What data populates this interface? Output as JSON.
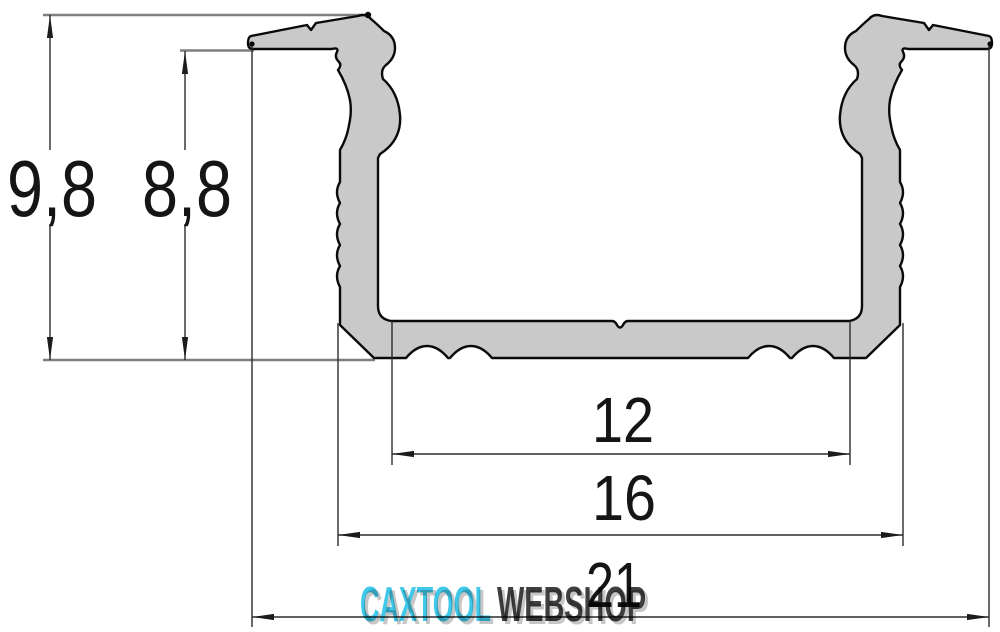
{
  "dims": {
    "height_outer": "9,8",
    "height_inner": "8,8",
    "width_inner": "12",
    "width_mid": "16",
    "width_overall": "21"
  },
  "watermark": {
    "brand": "CAXTOOL",
    "suffix": "WEBSHOP",
    "brand_color": "#3EC9EA",
    "suffix_color": "#3F3F3F"
  },
  "colors": {
    "background": "#FFFFFF",
    "profile_fill": "#C9C9C9",
    "outline": "#0A0A0A",
    "dimension_line": "#2B2B2B",
    "extension_line": "#7F7F7F"
  }
}
